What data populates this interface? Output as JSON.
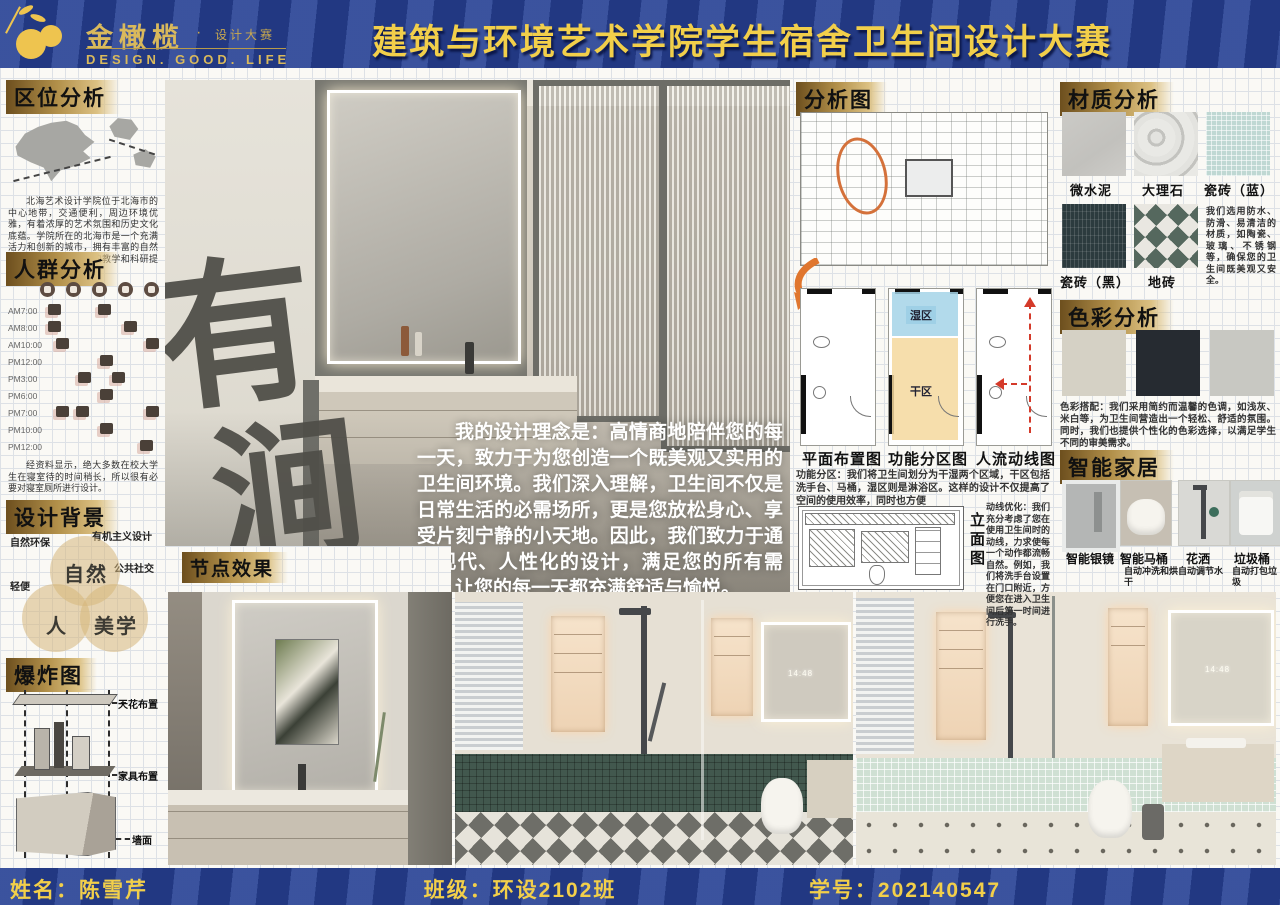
{
  "header": {
    "brand": "金橄榄",
    "brand_sub": "设计大赛",
    "tagline": "DESIGN.  GOOD.  LIFE",
    "title": "建筑与环境艺术学院学生宿舍卫生间设计大赛"
  },
  "footer": {
    "name": "姓名：陈雪芹",
    "class": "班级：环设2102班",
    "student_id": "学号：202140547"
  },
  "left": {
    "location": {
      "title": "区位分析",
      "note": "北海艺术设计学院位于北海市的中心地带，交通便利，周边环境优雅，有着浓厚的艺术氛围和历史文化底蕴。学院所在的北海市是一个充满活力和创新的城市，拥有丰富的自然和文化资源，为学院的教学和科研提供了得天独厚的条件。"
    },
    "crowd": {
      "title": "人群分析",
      "times": [
        "AM7:00",
        "AM8:00",
        "AM10:00",
        "PM12:00",
        "PM3:00",
        "PM6:00",
        "PM7:00",
        "PM10:00",
        "PM12:00"
      ],
      "note": "经资料显示，绝大多数在校大学生在寝室待的时间稍长，所以很有必要对寝室厕所进行设计。"
    },
    "design_bg": {
      "title": "设计背景",
      "tags": [
        "自然环保",
        "有机主义设计",
        "轻便",
        "公共社交"
      ],
      "venn": [
        "自然",
        "人",
        "美学"
      ]
    },
    "exploded": {
      "title": "爆炸图",
      "labels": [
        "天花布置",
        "家具布置",
        "墙面"
      ]
    }
  },
  "hero": {
    "calligraphy": [
      "有",
      "涧"
    ],
    "concept": "我的设计理念是：高情商地陪伴您的每一天，致力于为您创造一个既美观又实用的卫生间环境。我们深入理解，卫生间不仅是日常生活的必需场所，更是您放松身心、享受片刻宁静的小天地。因此，我们致力于通过现代、人性化的设计，满足您的所有需求，让您的每一天都充满舒适与愉悦。",
    "node_title": "节点效果",
    "mirror_time": "14:48"
  },
  "analysis": {
    "title": "分析图",
    "plans": [
      "平面布置图",
      "功能分区图",
      "人流动线图"
    ],
    "wet_label": "湿区",
    "dry_label": "干区",
    "zoning_note": "功能分区：我们将卫生间划分为干湿两个区域，干区包括洗手台、马桶，湿区则是淋浴区。这样的设计不仅提高了空间的使用效率，同时也方便",
    "elevation_label": "立面图",
    "circulation_note": "动线优化：我们充分考虑了您在使用卫生间时的动线，力求使每一个动作都流畅自然。例如，我们将洗手台设置在门口附近，方便您在进入卫生间后第一时间进行洗手。"
  },
  "materials": {
    "title": "材质分析",
    "labels": [
      "微水泥",
      "大理石",
      "瓷砖（蓝）",
      "瓷砖（黑）",
      "地砖"
    ],
    "note": "我们选用防水、防滑、易清洁的材质，如陶瓷、玻璃、不锈钢等，确保您的卫生间既美观又安全。"
  },
  "palette": {
    "title": "色彩分析",
    "swatches": [
      "#d5d1c5",
      "#262b31",
      "#c8c8c2"
    ],
    "note": "色彩搭配：我们采用简约而温馨的色调，如浅灰、米白等，为卫生间营造出一个轻松、舒适的氛围。同时，我们也提供个性化的色彩选择，以满足学生不同的审美需求。"
  },
  "smart": {
    "title": "智能家居",
    "items": [
      {
        "name": "智能银镜",
        "desc": ""
      },
      {
        "name": "智能马桶",
        "desc": "自动冲洗和烘干"
      },
      {
        "name": "花洒",
        "desc": "自动调节水"
      },
      {
        "name": "垃圾桶",
        "desc": "自动打包垃圾"
      }
    ]
  },
  "accents": {
    "bar_blue": "#2a4496",
    "title_yellow": "#f2cf4a",
    "wet_zone": "#b8dcec",
    "dry_zone": "#f5d89e",
    "highlight_orange": "#e0762e",
    "arrow_red": "#d43a2a"
  }
}
